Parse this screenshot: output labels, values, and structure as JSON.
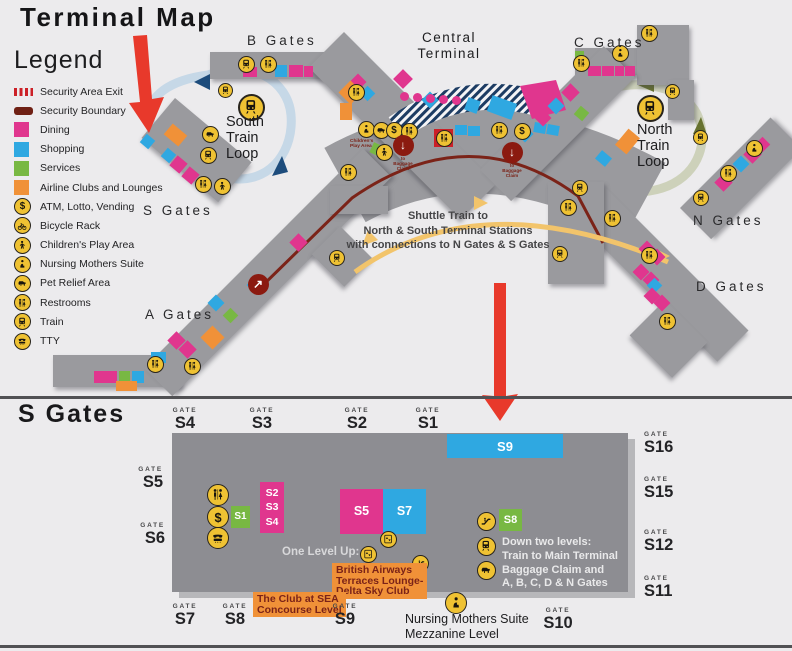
{
  "title": "Terminal Map",
  "legend": {
    "title": "Legend",
    "items": [
      {
        "id": "security-area-exit",
        "swatch": "exit",
        "label": "Security Area Exit"
      },
      {
        "id": "security-boundary",
        "swatch": "boundary",
        "label": "Security Boundary"
      },
      {
        "id": "dining",
        "swatch": "dining",
        "label": "Dining"
      },
      {
        "id": "shopping",
        "swatch": "shopping",
        "label": "Shopping"
      },
      {
        "id": "services",
        "swatch": "services",
        "label": "Services"
      },
      {
        "id": "airline-clubs",
        "swatch": "clubs",
        "label": "Airline Clubs and Lounges"
      },
      {
        "id": "atm",
        "swatch": "atm",
        "label": "ATM, Lotto, Vending"
      },
      {
        "id": "bicycle-rack",
        "swatch": "bike",
        "label": "Bicycle Rack"
      },
      {
        "id": "childrens-play-area",
        "swatch": "children",
        "label": "Children's Play Area"
      },
      {
        "id": "nursing-mothers-suite",
        "swatch": "nursing",
        "label": "Nursing Mothers Suite"
      },
      {
        "id": "pet-relief-area",
        "swatch": "pet",
        "label": "Pet Relief Area"
      },
      {
        "id": "restrooms",
        "swatch": "restroom",
        "label": "Restrooms"
      },
      {
        "id": "train",
        "swatch": "train",
        "label": "Train"
      },
      {
        "id": "tty",
        "swatch": "tty",
        "label": "TTY"
      }
    ]
  },
  "upper": {
    "labels": {
      "b": "B Gates",
      "c": "C Gates",
      "central": "Central\nTerminal",
      "south_loop": "South\nTrain\nLoop",
      "north_loop": "North\nTrain\nLoop",
      "s": "S Gates",
      "n": "N Gates",
      "a": "A Gates",
      "d": "D Gates"
    },
    "shuttle_note": "Shuttle Train to\nNorth & South Terminal Stations\nwith connections to N Gates & S Gates",
    "children_note": "Children's\nPlay Area",
    "baggage_note": "to\nBaggage\nClaim",
    "markers": [
      [
        "train",
        246,
        64
      ],
      [
        "restroom",
        268,
        64
      ],
      [
        "restroom",
        356,
        92
      ],
      [
        "train",
        225,
        90,
        15
      ],
      [
        "train",
        251,
        107,
        27
      ],
      [
        "pet",
        210,
        134
      ],
      [
        "train",
        208,
        155
      ],
      [
        "restroom",
        203,
        184
      ],
      [
        "children",
        222,
        186
      ],
      [
        "nursing",
        366,
        129
      ],
      [
        "pet",
        381,
        130
      ],
      [
        "atm",
        394,
        130
      ],
      [
        "restroom",
        409,
        131
      ],
      [
        "children",
        384,
        152
      ],
      [
        "restroom",
        444,
        138
      ],
      [
        "restroom",
        499,
        130
      ],
      [
        "atm",
        522,
        131
      ],
      [
        "restroom",
        348,
        172
      ],
      [
        "restroom",
        568,
        207
      ],
      [
        "restroom",
        612,
        218
      ],
      [
        "train",
        580,
        188,
        16
      ],
      [
        "train",
        560,
        254,
        16
      ],
      [
        "train",
        337,
        258,
        16
      ],
      [
        "restroom",
        581,
        63
      ],
      [
        "nursing",
        620,
        53
      ],
      [
        "restroom",
        649,
        33
      ],
      [
        "train",
        650,
        108,
        27
      ],
      [
        "train",
        672,
        91,
        15
      ],
      [
        "train",
        700,
        137,
        15
      ],
      [
        "train",
        701,
        198,
        16
      ],
      [
        "restroom",
        728,
        173
      ],
      [
        "nursing",
        754,
        148
      ],
      [
        "restroom",
        155,
        364
      ],
      [
        "restroom",
        192,
        366
      ],
      [
        "restroom",
        649,
        255
      ],
      [
        "restroom",
        667,
        321
      ]
    ],
    "exits": [
      [
        403,
        145,
        "↓"
      ],
      [
        512,
        152,
        "↓"
      ],
      [
        258,
        284,
        "↗"
      ]
    ],
    "squares": [
      [
        "d",
        243,
        67,
        14,
        10,
        0
      ],
      [
        "sh",
        275,
        65,
        12,
        12,
        0
      ],
      [
        "d",
        289,
        65,
        14,
        12,
        0
      ],
      [
        "d",
        304,
        66,
        9,
        11,
        0
      ],
      [
        "d",
        396,
        72,
        14,
        14,
        45
      ],
      [
        "sh",
        424,
        94,
        12,
        12,
        45
      ],
      [
        "d",
        352,
        76,
        12,
        12,
        45
      ],
      [
        "cl",
        342,
        84,
        17,
        17,
        45
      ],
      [
        "sh",
        362,
        88,
        11,
        11,
        45
      ],
      [
        "cl",
        166,
        128,
        19,
        14,
        40
      ],
      [
        "sh",
        142,
        136,
        11,
        11,
        40
      ],
      [
        "sh",
        163,
        150,
        11,
        11,
        40
      ],
      [
        "d",
        172,
        158,
        13,
        13,
        40
      ],
      [
        "d",
        184,
        169,
        13,
        13,
        40
      ],
      [
        "cl",
        340,
        103,
        12,
        17,
        0
      ],
      [
        "sv",
        371,
        145,
        16,
        11,
        25
      ],
      [
        "sh",
        466,
        99,
        13,
        13,
        20
      ],
      [
        "sh",
        489,
        99,
        26,
        17,
        20
      ],
      [
        "sh",
        455,
        125,
        12,
        10,
        0
      ],
      [
        "sh",
        468,
        126,
        12,
        10,
        0
      ],
      [
        "sh",
        534,
        123,
        12,
        10,
        10
      ],
      [
        "sh",
        547,
        125,
        12,
        10,
        10
      ],
      [
        "cl",
        620,
        131,
        15,
        21,
        40
      ],
      [
        "sh",
        597,
        153,
        13,
        11,
        40
      ],
      [
        "sv",
        576,
        108,
        11,
        11,
        40
      ],
      [
        "xp",
        434,
        129,
        19,
        18,
        0
      ],
      [
        "sv",
        575,
        51,
        9,
        9,
        0
      ],
      [
        "d",
        588,
        66,
        13,
        10,
        0
      ],
      [
        "d",
        602,
        66,
        12,
        10,
        0
      ],
      [
        "d",
        615,
        66,
        9,
        10,
        0
      ],
      [
        "d",
        625,
        66,
        10,
        10,
        0
      ],
      [
        "d",
        564,
        86,
        13,
        13,
        -45
      ],
      [
        "sh",
        550,
        100,
        12,
        12,
        -45
      ],
      [
        "d",
        537,
        112,
        12,
        12,
        -45
      ],
      [
        "sh",
        519,
        128,
        12,
        12,
        -45
      ],
      [
        "d",
        94,
        371,
        23,
        12,
        0
      ],
      [
        "sv",
        119,
        371,
        11,
        12,
        0
      ],
      [
        "sh",
        132,
        371,
        12,
        12,
        0
      ],
      [
        "sh",
        151,
        352,
        15,
        11,
        0
      ],
      [
        "cl",
        116,
        381,
        21,
        10,
        0
      ],
      [
        "d",
        170,
        334,
        13,
        13,
        -45
      ],
      [
        "d",
        181,
        343,
        13,
        13,
        -45
      ],
      [
        "cl",
        204,
        329,
        17,
        17,
        -45
      ],
      [
        "sh",
        210,
        297,
        12,
        12,
        -45
      ],
      [
        "sv",
        225,
        310,
        11,
        11,
        -45
      ],
      [
        "sh",
        249,
        279,
        12,
        12,
        -45
      ],
      [
        "d",
        292,
        236,
        13,
        13,
        -45
      ],
      [
        "d",
        641,
        243,
        12,
        12,
        -45
      ],
      [
        "d",
        651,
        251,
        12,
        12,
        -45
      ],
      [
        "d",
        635,
        266,
        12,
        12,
        -45
      ],
      [
        "d",
        645,
        274,
        12,
        12,
        -45
      ],
      [
        "sh",
        649,
        280,
        11,
        11,
        -45
      ],
      [
        "d",
        646,
        290,
        12,
        12,
        -45
      ],
      [
        "d",
        656,
        297,
        12,
        12,
        -45
      ],
      [
        "sh",
        735,
        158,
        12,
        12,
        -45
      ],
      [
        "d",
        746,
        148,
        13,
        13,
        -45
      ],
      [
        "d",
        717,
        176,
        13,
        13,
        -45
      ],
      [
        "d",
        757,
        139,
        11,
        11,
        -45
      ]
    ],
    "dining_dots": [
      [
        404,
        96
      ],
      [
        417,
        97
      ],
      [
        430,
        98
      ],
      [
        443,
        99
      ],
      [
        456,
        100
      ]
    ]
  },
  "detail": {
    "title": "S Gates",
    "gate_word": "GATE",
    "gates": [
      [
        "S4",
        185,
        407,
        "top"
      ],
      [
        "S3",
        262,
        407,
        "top"
      ],
      [
        "S2",
        357,
        407,
        "top"
      ],
      [
        "S1",
        428,
        407,
        "top"
      ],
      [
        "S5",
        163,
        466,
        "left"
      ],
      [
        "S6",
        165,
        522,
        "left"
      ],
      [
        "S16",
        644,
        431,
        "right"
      ],
      [
        "S15",
        644,
        476,
        "right"
      ],
      [
        "S12",
        644,
        529,
        "right"
      ],
      [
        "S11",
        644,
        575,
        "right"
      ],
      [
        "S7",
        185,
        603,
        "bottom"
      ],
      [
        "S8",
        235,
        603,
        "bottom"
      ],
      [
        "S9",
        345,
        603,
        "bottom"
      ],
      [
        "S10",
        558,
        607,
        "bottom"
      ]
    ],
    "blocks": [
      [
        "S9",
        "sh",
        447,
        434,
        116,
        24,
        13
      ],
      [
        "S2\nS3\nS4",
        "d",
        260,
        482,
        24,
        51,
        10.5
      ],
      [
        "S1",
        "sv",
        231,
        506,
        19,
        22,
        10
      ],
      [
        "S5",
        "d",
        340,
        489,
        43,
        45,
        12.5
      ],
      [
        "S7",
        "sh",
        383,
        489,
        43,
        45,
        12.5
      ],
      [
        "S8",
        "sv",
        499,
        509,
        23,
        22,
        11
      ]
    ],
    "markers": [
      [
        "restroom",
        218,
        495,
        22
      ],
      [
        "atm",
        218,
        517,
        22
      ],
      [
        "tty",
        218,
        538,
        22
      ],
      [
        "elevator",
        388,
        539,
        17
      ],
      [
        "elevator",
        368,
        554,
        17
      ],
      [
        "escalator",
        420,
        563,
        17
      ],
      [
        "escalator",
        486,
        521,
        19
      ],
      [
        "train",
        486,
        546,
        19
      ],
      [
        "pet",
        486,
        570,
        19
      ],
      [
        "nursing",
        456,
        603,
        22
      ]
    ],
    "one_level_up": "One Level Up:",
    "down_levels": "Down two levels:\nTrain to Main Terminal\nBaggage Claim and\nA, B, C, D & N Gates",
    "ba_lounge": "British Airways\nTerraces Lounge-\nDelta Sky Club",
    "club_sea": "The Club at SEA\nConcourse Level",
    "nursing_note": "Nursing Mothers Suite\nMezzanine Level"
  },
  "colors": {
    "dining": "#e0368e",
    "shopping": "#2fa8e1",
    "services": "#78b843",
    "clubs": "#f09138",
    "security_boundary": "#6f2014",
    "security_exit": "#cc2027",
    "icon_yellow": "#efc233",
    "concourse_gray": "#9a9a9e",
    "red_arrow": "#e8392b",
    "south_loop": "#c6d8e7",
    "north_loop": "#cdd1ba",
    "shuttle_gold": "#f2c46b"
  }
}
